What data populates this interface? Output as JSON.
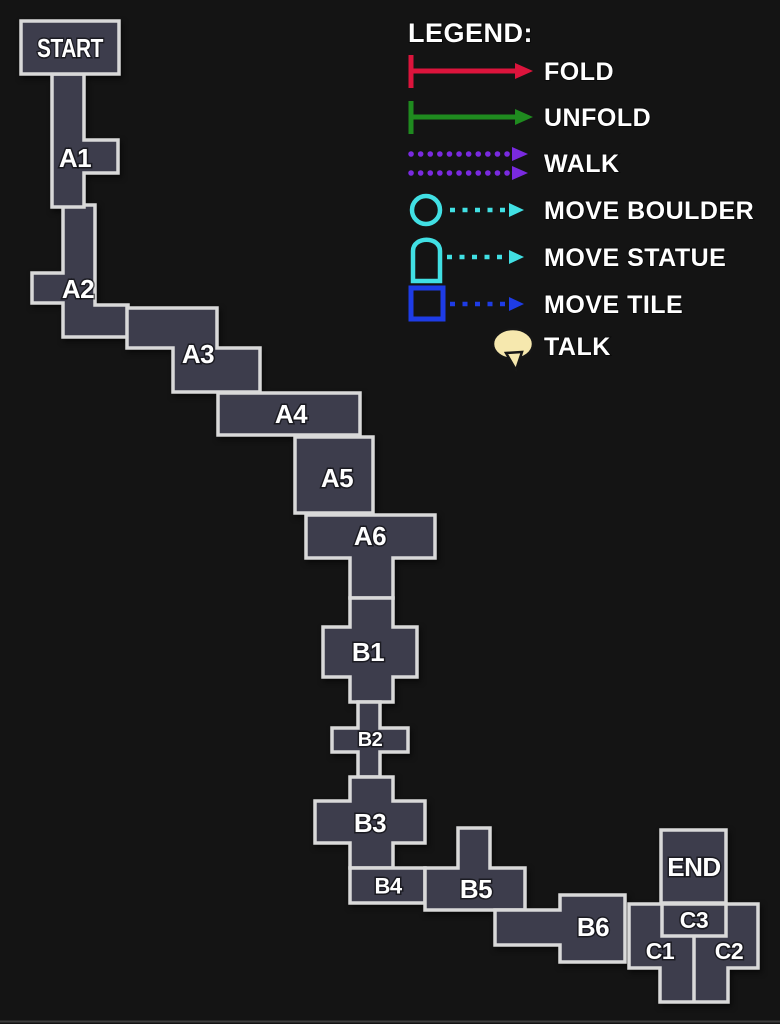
{
  "colors": {
    "background": "#141414",
    "room-fill": "#3d3d4c",
    "room-border": "#d9d9d9",
    "label-color": "#ffffff"
  },
  "legend": {
    "title": "LEGEND:",
    "items": [
      {
        "id": "fold",
        "label": "FOLD",
        "icon": "fold-arrow-icon",
        "color": "#dc143c"
      },
      {
        "id": "unfold",
        "label": "UNFOLD",
        "icon": "unfold-arrow-icon",
        "color": "#1f8b1f"
      },
      {
        "id": "walk",
        "label": "WALK",
        "icon": "walk-arrows-icon",
        "color": "#7a2ae0"
      },
      {
        "id": "move-boulder",
        "label": "MOVE BOULDER",
        "icon": "boulder-icon",
        "color": "#41e0e4"
      },
      {
        "id": "move-statue",
        "label": "MOVE STATUE",
        "icon": "statue-icon",
        "color": "#41e0e4"
      },
      {
        "id": "move-tile",
        "label": "MOVE TILE",
        "icon": "tile-icon",
        "color": "#1e3ce6"
      },
      {
        "id": "talk",
        "label": "TALK",
        "icon": "talk-bubble-icon",
        "color": "#f6e8ae"
      }
    ]
  },
  "map": {
    "rooms": {
      "start": {
        "label": "START"
      },
      "a1": {
        "label": "A1"
      },
      "a2": {
        "label": "A2"
      },
      "a3": {
        "label": "A3"
      },
      "a4": {
        "label": "A4"
      },
      "a5": {
        "label": "A5"
      },
      "a6": {
        "label": "A6"
      },
      "b1": {
        "label": "B1"
      },
      "b2": {
        "label": "B2"
      },
      "b3": {
        "label": "B3"
      },
      "b4": {
        "label": "B4"
      },
      "b5": {
        "label": "B5"
      },
      "b6": {
        "label": "B6"
      },
      "c1": {
        "label": "C1"
      },
      "c2": {
        "label": "C2"
      },
      "c3": {
        "label": "C3"
      },
      "end": {
        "label": "END"
      }
    }
  }
}
